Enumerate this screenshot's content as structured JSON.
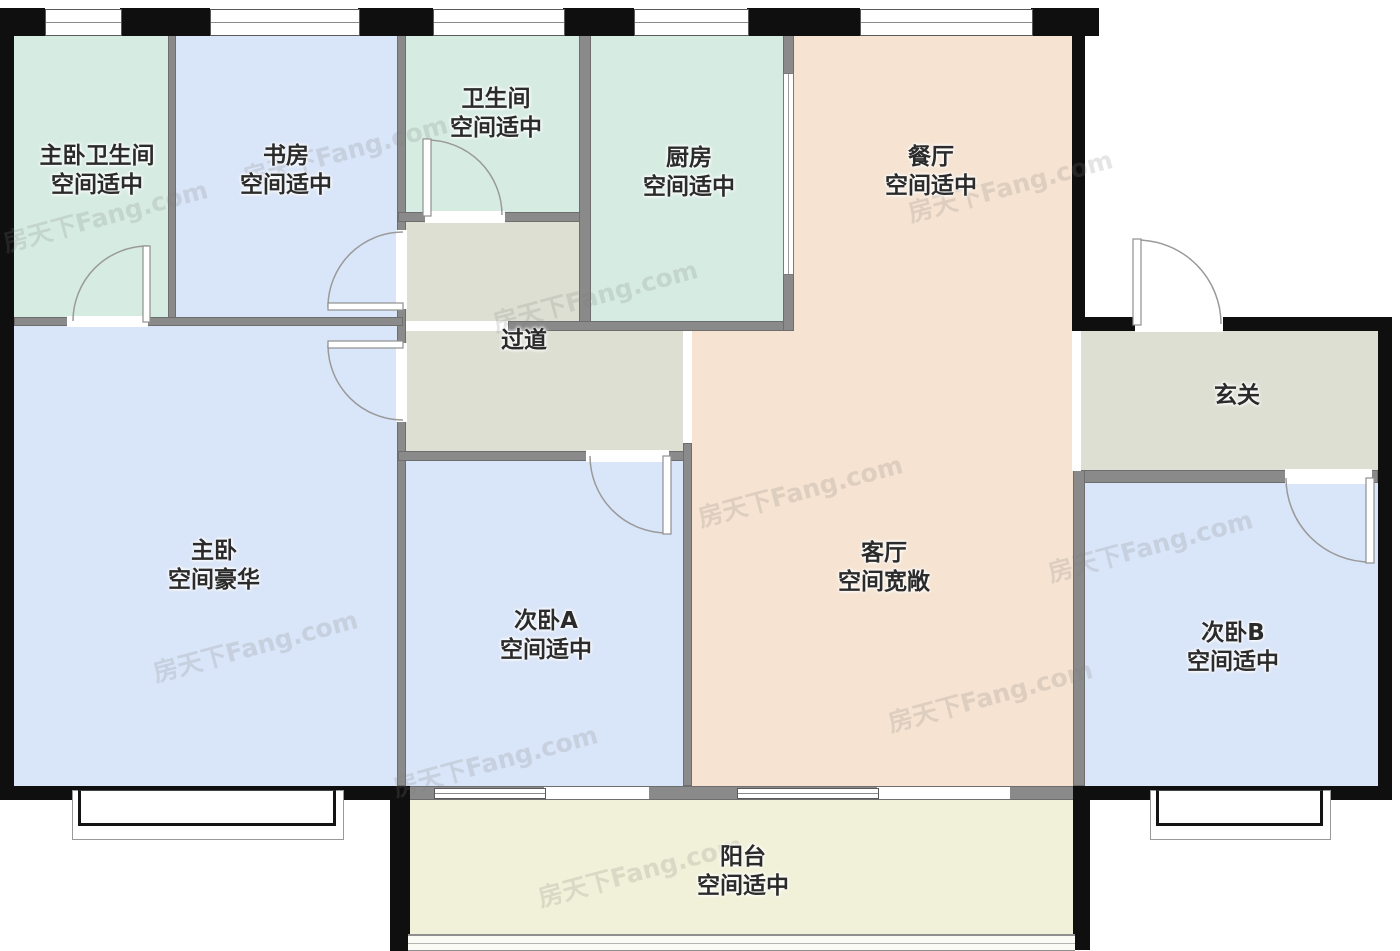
{
  "floorplan": {
    "watermark": "房天下Fang.com",
    "colors": {
      "wall": "#0f0f0f",
      "interior_wall": "#8a8a8a",
      "bath_teal": "#d6ece3",
      "bedroom_blue": "#d9e5f8",
      "living_peach": "#f6e3d1",
      "hall_gray": "#dedfd3",
      "balcony_yellow": "#f1f1d9",
      "label_text": "#2b2b2b"
    },
    "rooms": [
      {
        "name": "主卧卫生间",
        "desc": "空间适中"
      },
      {
        "name": "书房",
        "desc": "空间适中"
      },
      {
        "name": "卫生间",
        "desc": "空间适中"
      },
      {
        "name": "厨房",
        "desc": "空间适中"
      },
      {
        "name": "餐厅",
        "desc": "空间适中"
      },
      {
        "name": "过道",
        "desc": ""
      },
      {
        "name": "玄关",
        "desc": ""
      },
      {
        "name": "主卧",
        "desc": "空间豪华"
      },
      {
        "name": "次卧A",
        "desc": "空间适中"
      },
      {
        "name": "客厅",
        "desc": "空间宽敞"
      },
      {
        "name": "次卧B",
        "desc": "空间适中"
      },
      {
        "name": "阳台",
        "desc": "空间适中"
      }
    ]
  }
}
